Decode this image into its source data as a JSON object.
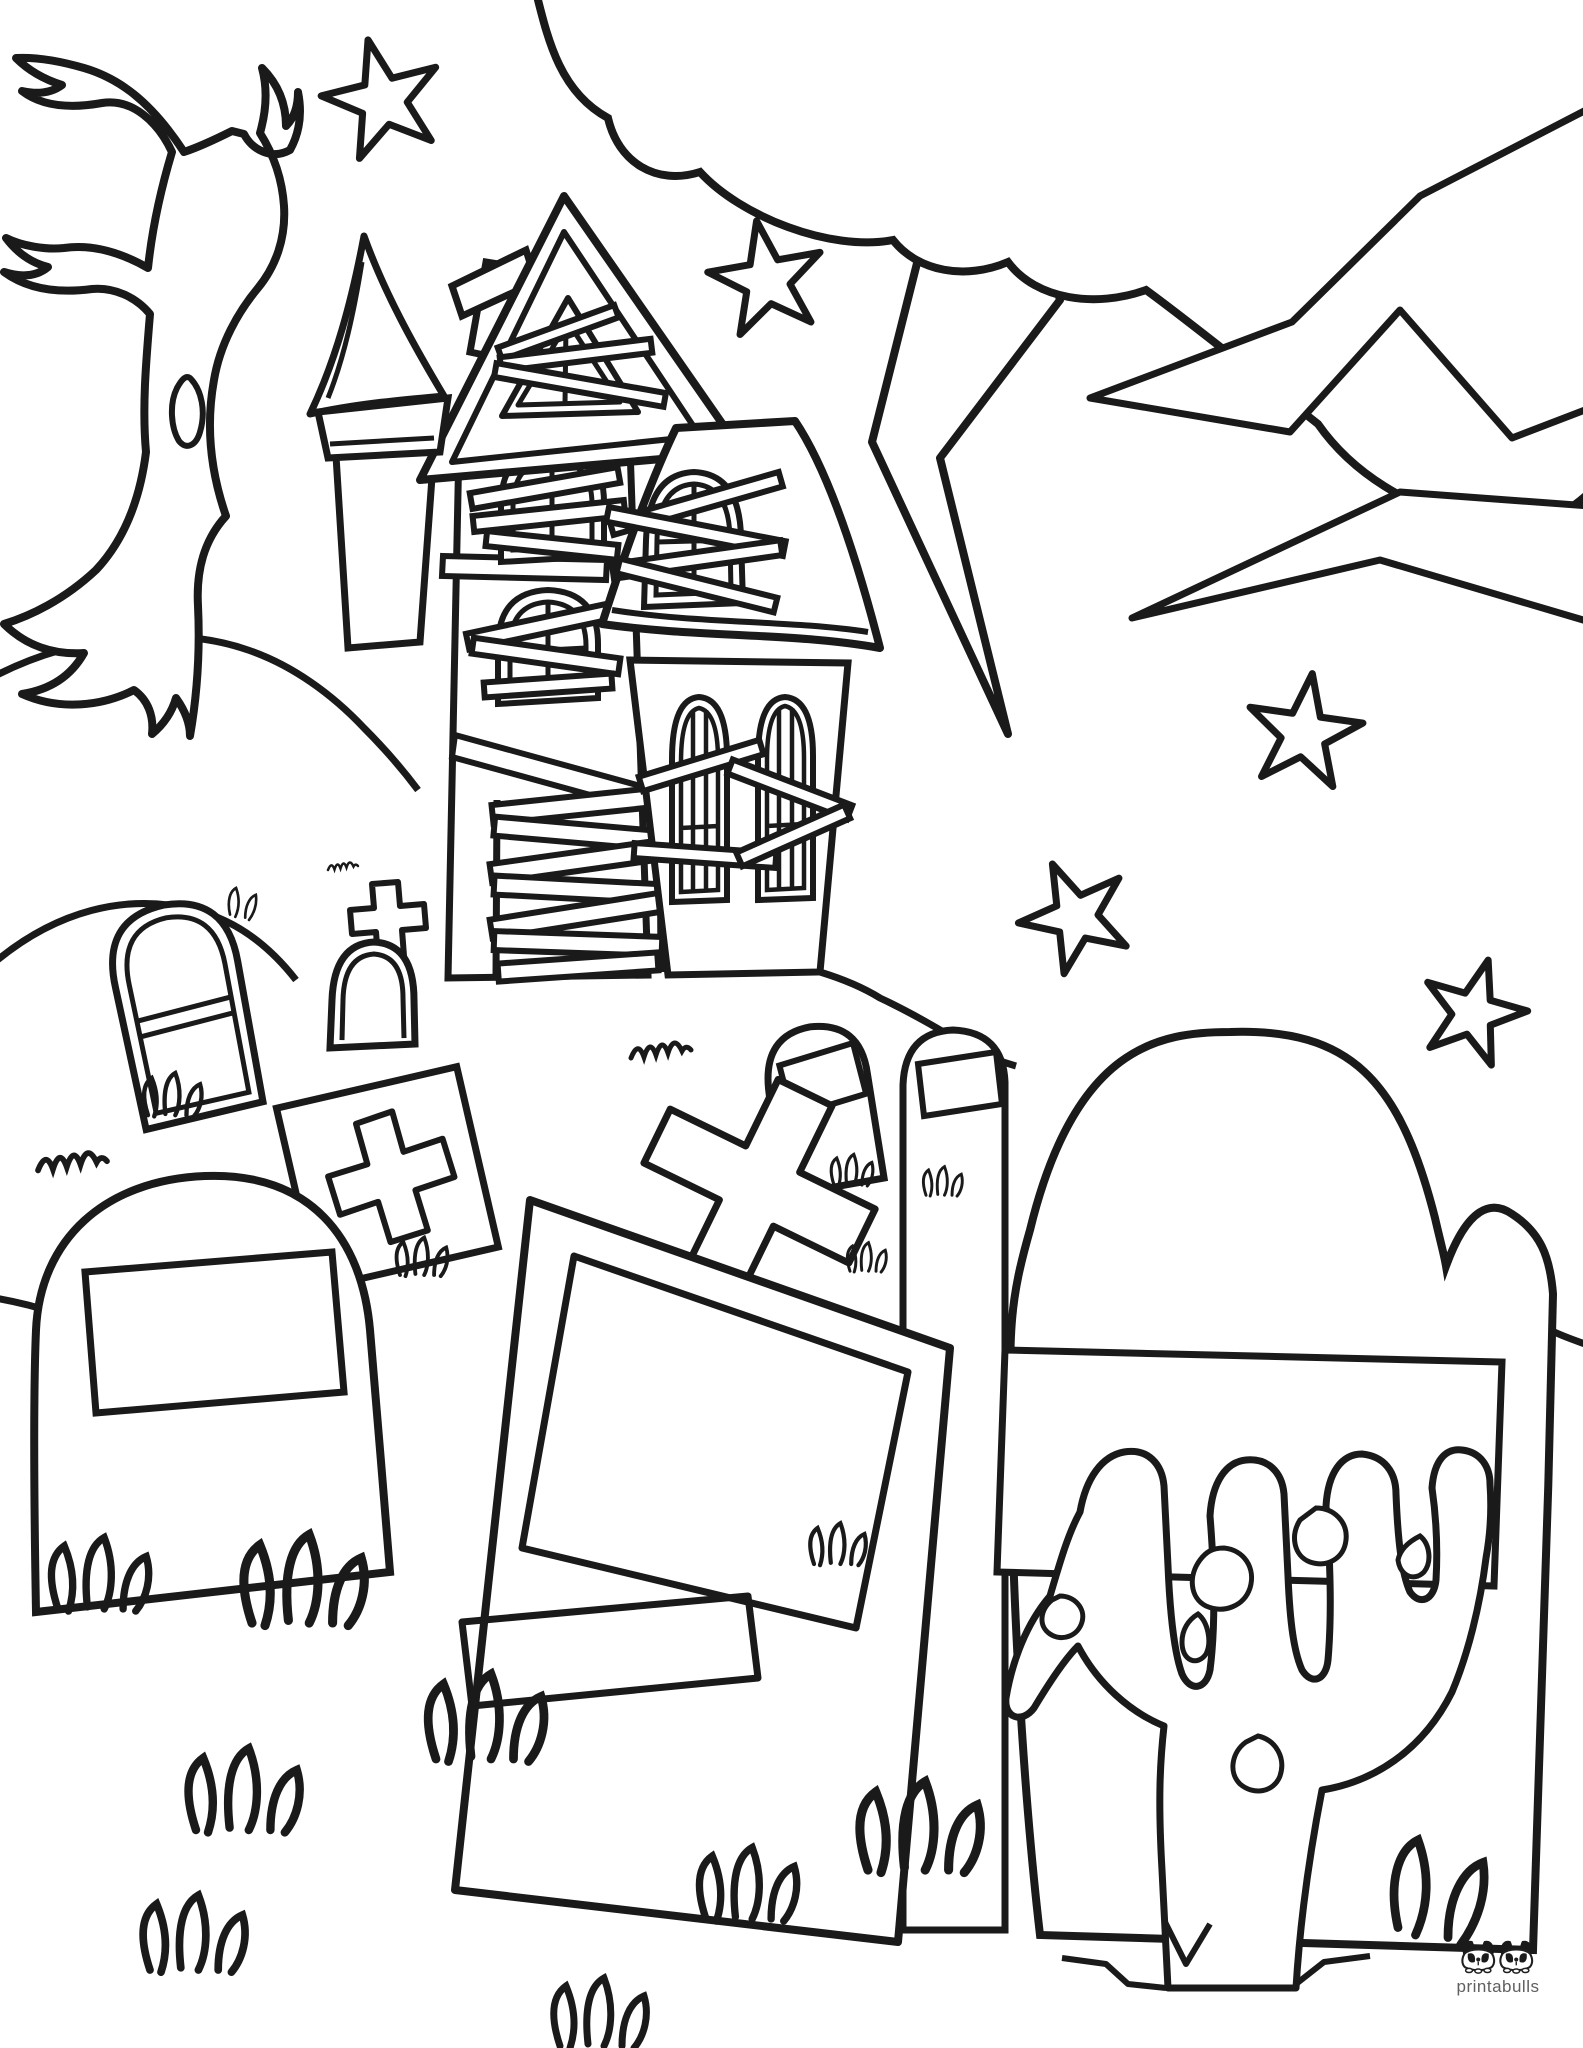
{
  "canvas": {
    "width": 1583,
    "height": 2048,
    "background": "#ffffff",
    "ink": "#1a1a1a"
  },
  "watermark": {
    "brand": "printabulls",
    "logo_icon": "two-french-bulldogs-icon",
    "text_color": "#5f5f5f"
  },
  "scene": {
    "description": "Halloween haunted-house graveyard coloring page (black and white line art)",
    "elements": [
      "spooky-bare-tree",
      "haunted-house",
      "steeple",
      "boarded-attic-window",
      "chimney",
      "boarded-arched-windows",
      "boarded-door",
      "cone-roof-tower",
      "storm-cloud",
      "lightning-bolt",
      "stars",
      "arched-gravestone",
      "cross-top-gravestone",
      "plus-carved-gravestone",
      "tilted-cross-gravestone",
      "large-gravestones",
      "zombie-hand",
      "grass-tufts",
      "ground-cracks"
    ]
  }
}
